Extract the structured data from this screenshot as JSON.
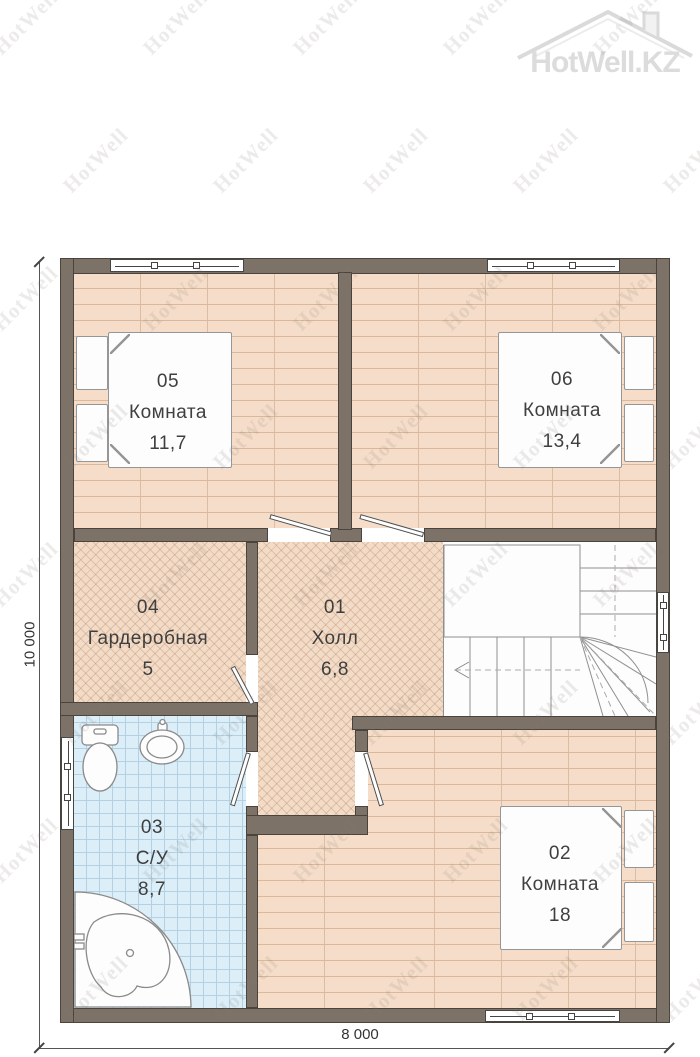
{
  "logo": {
    "brand": "HotWell.KZ"
  },
  "watermark": {
    "text": "HotWell"
  },
  "dimensions": {
    "height": "10 000",
    "width": "8 000"
  },
  "rooms": {
    "r05": {
      "number": "05",
      "name": "Комната",
      "area": "11,7"
    },
    "r06": {
      "number": "06",
      "name": "Комната",
      "area": "13,4"
    },
    "r04": {
      "number": "04",
      "name": "Гардеробная",
      "area": "5"
    },
    "r01": {
      "number": "01",
      "name": "Холл",
      "area": "6,8"
    },
    "r03": {
      "number": "03",
      "name": "С/У",
      "area": "8,7"
    },
    "r02": {
      "number": "02",
      "name": "Комната",
      "area": "18"
    }
  },
  "colors": {
    "wall": "#7d7267",
    "wall_outline": "#4a443c",
    "floor_plank": "#f6ddc9",
    "floor_plank_line": "#d9b89b",
    "floor_parquet": "#f3dcc7",
    "floor_parquet_line": "#c99f7e",
    "floor_tile": "#dceef8",
    "floor_tile_line": "#b3d1e2",
    "fixture_line": "#8a8a8a",
    "dim_line": "#555555",
    "label_text": "#3f3f3f",
    "watermark_gray": "#d9d9d9"
  }
}
